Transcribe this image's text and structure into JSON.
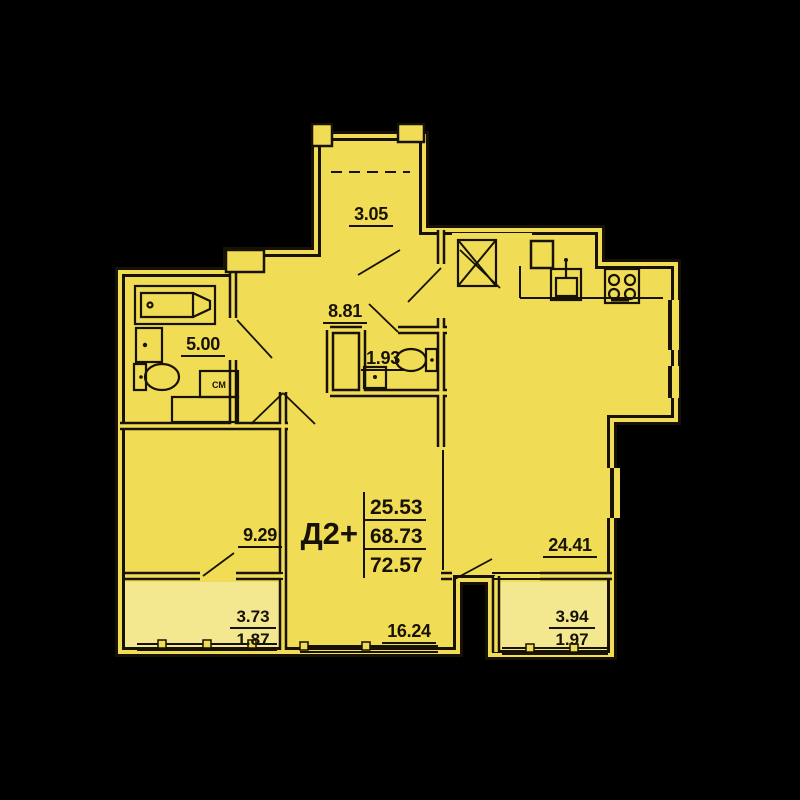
{
  "unit": {
    "code": "Д2+",
    "values": [
      "25.53",
      "68.73",
      "72.57"
    ]
  },
  "rooms": {
    "balcony_top": {
      "area": "3.05"
    },
    "hallway": {
      "area": "8.81"
    },
    "wc": {
      "area": "1.93"
    },
    "bathroom": {
      "area": "5.00"
    },
    "bedroom_left": {
      "area": "9.29"
    },
    "room_center": {
      "area": "16.24"
    },
    "kitchen_living": {
      "area": "24.41"
    },
    "balcony_left": {
      "area": "3.73",
      "area_coeff": "1.87"
    },
    "balcony_right": {
      "area": "3.94",
      "area_coeff": "1.97"
    }
  },
  "fixtures": {
    "washing_machine": "СМ"
  },
  "colors": {
    "background": "#000000",
    "floor": "#f0dc55",
    "balcony_floor": "#f3e88f",
    "line": "#171203"
  }
}
